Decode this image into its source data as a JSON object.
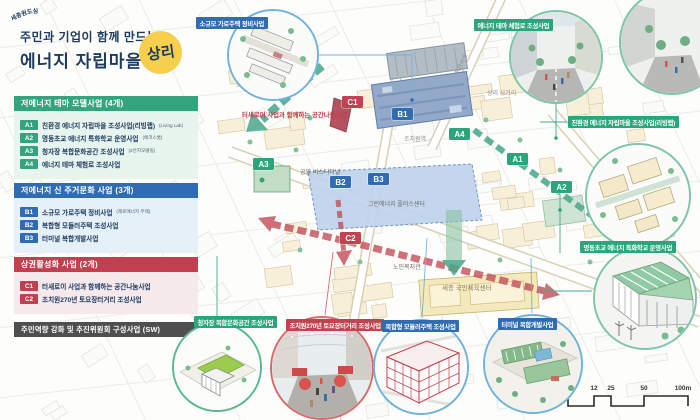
{
  "title": {
    "line1": "주민과 기업이 함께 만드는",
    "line2": "에너지 자립마을",
    "logo": "상리",
    "logo_arc": "세종원도심"
  },
  "colors": {
    "green": "#2aa57c",
    "blue": "#2f6cb3",
    "red": "#c24251",
    "dark_bar": "#4f4f4f",
    "navy": "#1d3a5f",
    "logo_yellow": "#f6d04d"
  },
  "legend": {
    "sections": [
      {
        "header": "저에너지 테마 모델사업 (4개)",
        "items": [
          {
            "code": "A1",
            "label": "친환경 에너지 자립마을 조성사업(리빙랩)",
            "note": "(Living Lab)"
          },
          {
            "code": "A2",
            "label": "명동초교 에너지 특화학교 운영사업",
            "note": "(에코스쿨)"
          },
          {
            "code": "A3",
            "label": "청자장 복합문화공간 조성사업",
            "note": "(2안지모델링)"
          },
          {
            "code": "A4",
            "label": "에너지 테마 체험로 조성사업",
            "note": ""
          }
        ]
      },
      {
        "header": "저에너지 신 주거문화 사업 (3개)",
        "items": [
          {
            "code": "B1",
            "label": "소규모 가로주택 정비사업",
            "note": "(제로에너지 주택)"
          },
          {
            "code": "B2",
            "label": "복합형 모듈러주택 조성사업",
            "note": ""
          },
          {
            "code": "B3",
            "label": "터미널 복합개발사업",
            "note": ""
          }
        ]
      },
      {
        "header": "상권활성화 사업 (2개)",
        "items": [
          {
            "code": "C1",
            "label": "터새로이 사업과 함께하는 공간나눔사업",
            "note": ""
          },
          {
            "code": "C2",
            "label": "조치원270년 토요장터거리 조성사업",
            "note": ""
          }
        ]
      }
    ],
    "sw_bar": "주민역량 강화 및 추진위원회 구성사업 (SW)"
  },
  "map": {
    "badges": [
      {
        "code": "A1"
      },
      {
        "code": "A2"
      },
      {
        "code": "A3"
      },
      {
        "code": "A4"
      },
      {
        "code": "B1"
      },
      {
        "code": "B2"
      },
      {
        "code": "B3"
      },
      {
        "code": "C1"
      },
      {
        "code": "C2"
      }
    ],
    "labels": {
      "station": "조치원역",
      "bus_terminal": "공영 버스터미널",
      "plus_center": "그린에너지 플러스센터",
      "senior_center": "노인복지관",
      "sports_center": "세종 국민체육센터",
      "crossroad": "상리 사거리",
      "road": "허만서로",
      "c1_note": "터새로이 사업과 함께하는 공간나눔사업",
      "parking": "P"
    }
  },
  "callouts": [
    {
      "label": "소규모 가로주택 정비사업"
    },
    {
      "label": "에너지 테마 체험로 조성사업"
    },
    {
      "label": "친환경 에너지 자립마을 조성사업(리빙랩)"
    },
    {
      "label": "명동초교 에너지 특화학교 운영사업"
    },
    {
      "label": "청자장 복합문화공간 조성사업"
    },
    {
      "label": "조치원270년 토요장터거리 조성사업"
    },
    {
      "label": "복합형 모듈러주택 조성사업"
    },
    {
      "label": "터미널 복합개발사업"
    }
  ],
  "compass": {
    "label": "N"
  },
  "scalebar": {
    "ticks": [
      "0",
      "12",
      "25",
      "50",
      "100m"
    ]
  }
}
